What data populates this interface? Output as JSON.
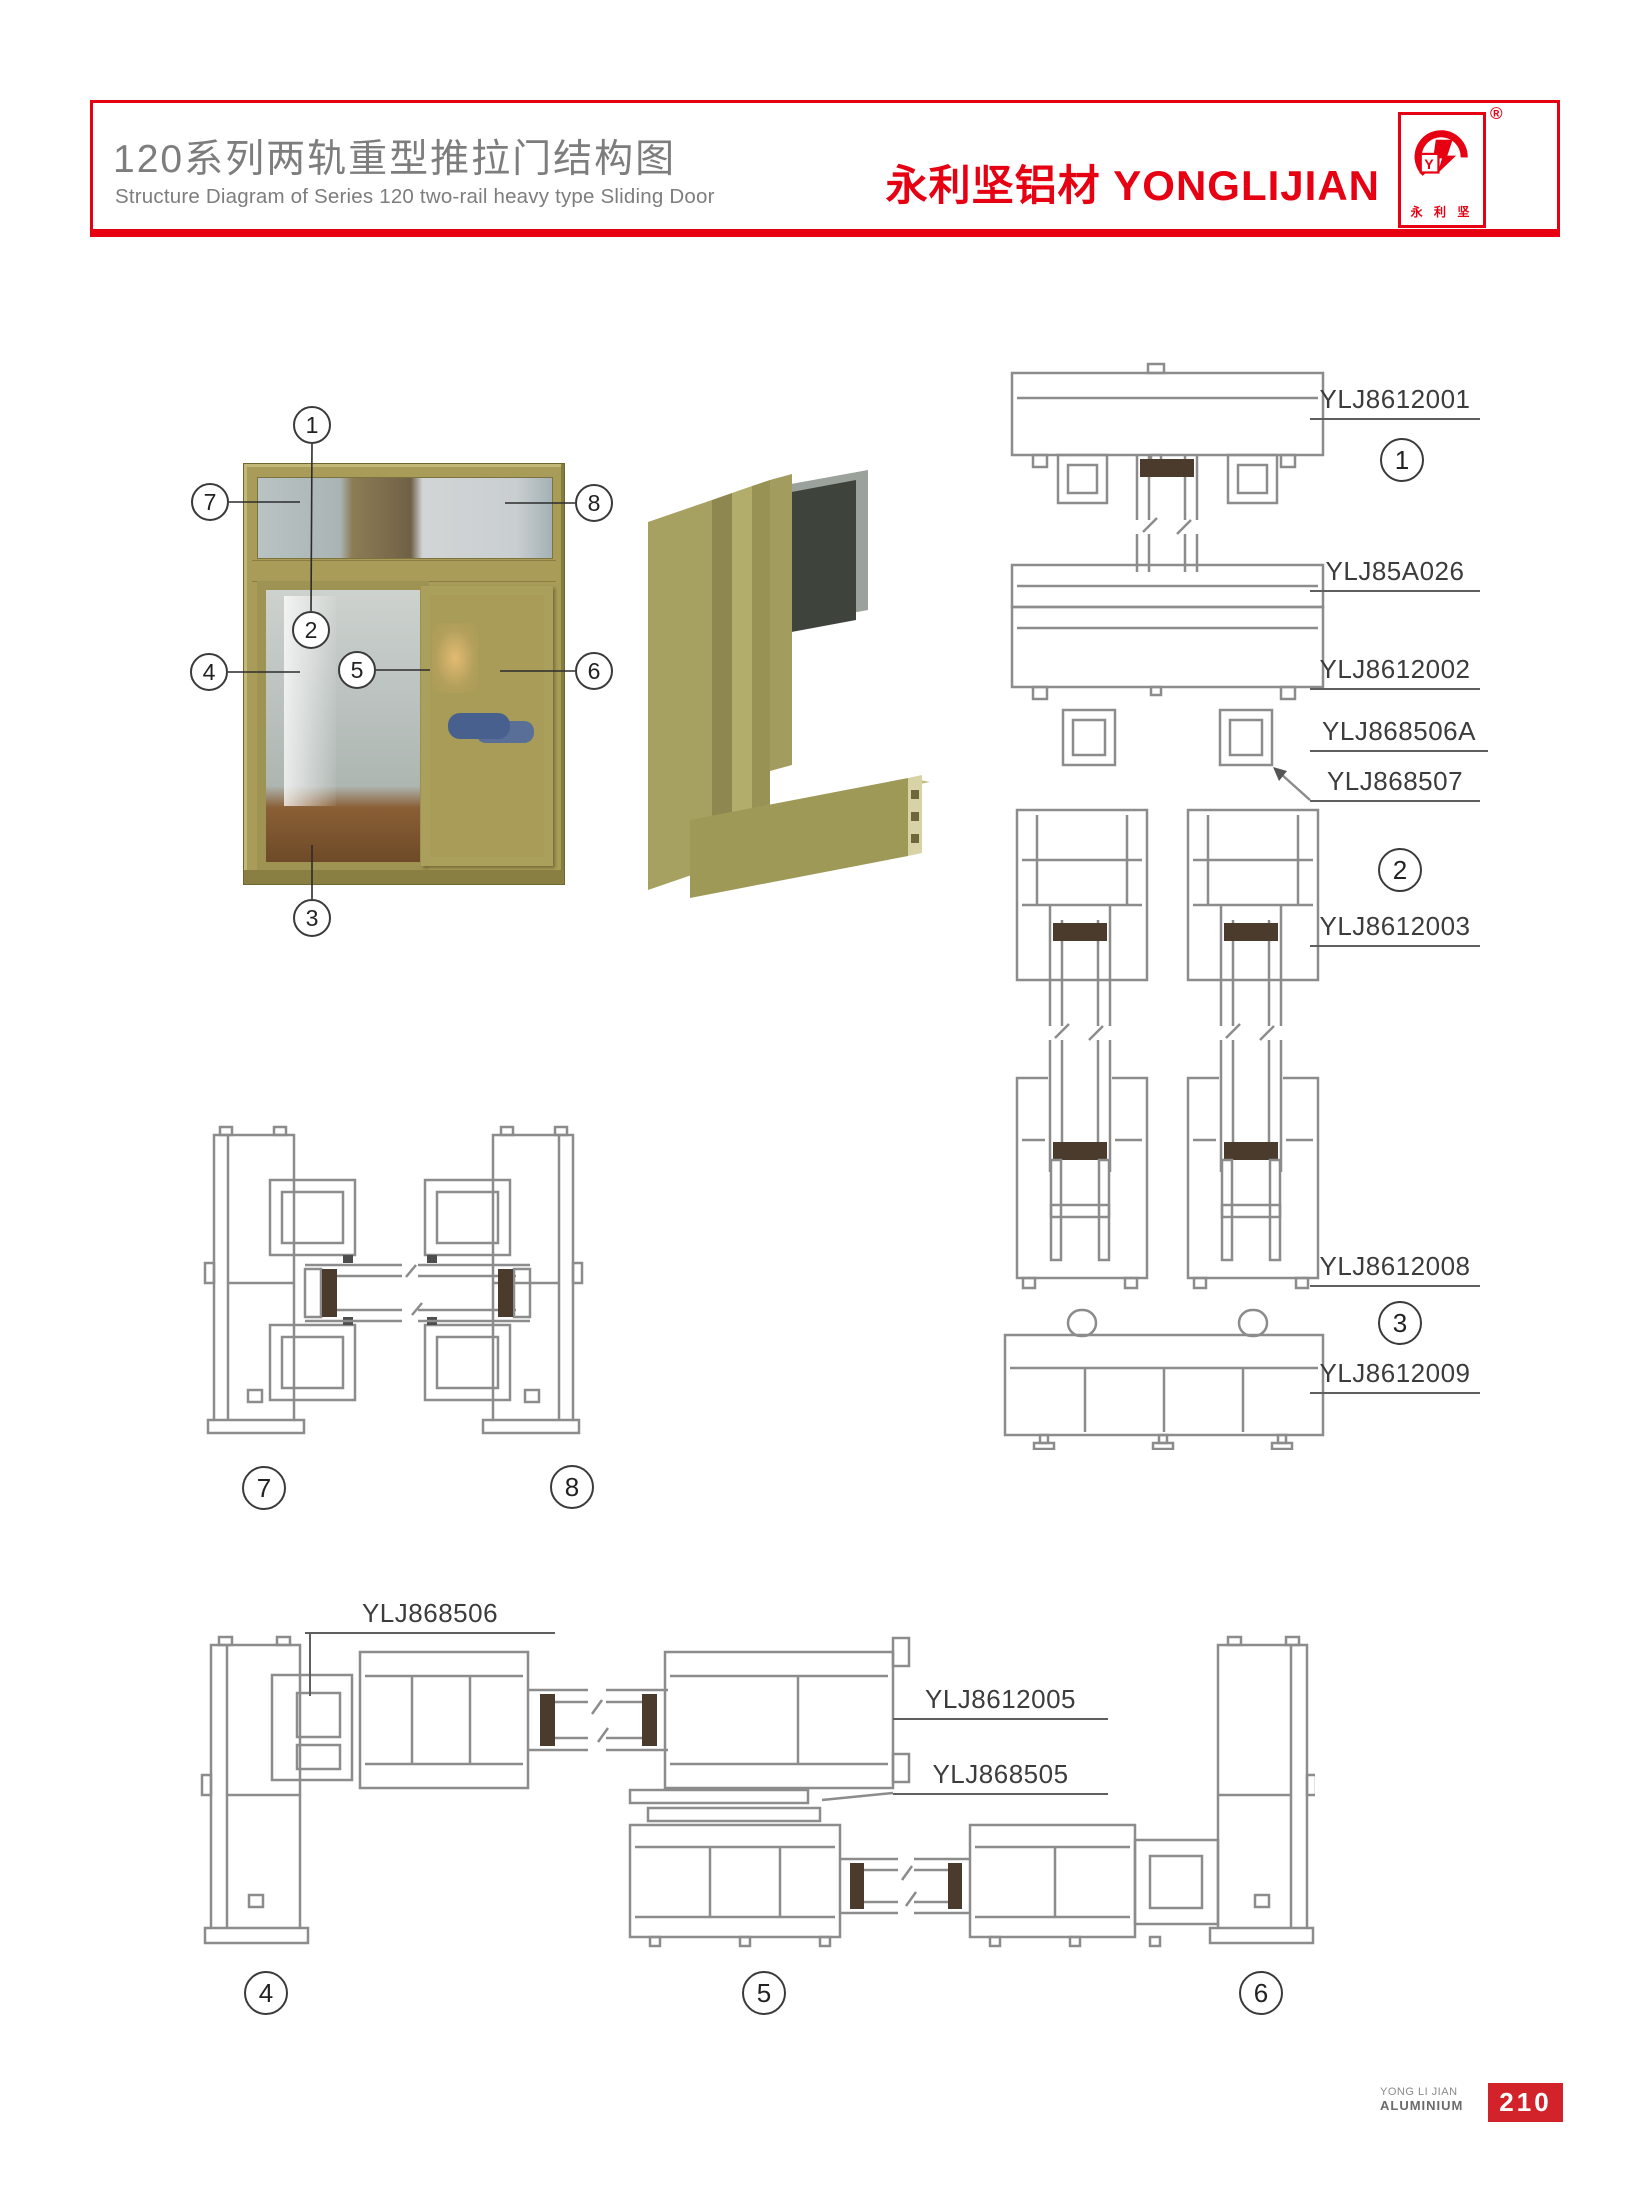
{
  "header": {
    "title_zh": "120系列两轨重型推拉门结构图",
    "title_en": "Structure Diagram of Series 120 two-rail heavy type Sliding Door",
    "brand": "永利坚铝材 YONGLIJIAN",
    "logo": {
      "registered": "®",
      "caption": "永 利 坚",
      "monogram": "Y"
    }
  },
  "colors": {
    "accent_red": "#e60012",
    "page_badge_red": "#d3232a",
    "title_gray": "#7d7d7d",
    "drawing_gray": "#8c8c8c",
    "frame_olive": "#a89c58"
  },
  "window_callouts": [
    "1",
    "7",
    "8",
    "2",
    "4",
    "5",
    "6",
    "3"
  ],
  "section_callouts": {
    "right": [
      "1",
      "2",
      "3"
    ],
    "middle": [
      "7",
      "8"
    ],
    "bottom": [
      "4",
      "5",
      "6"
    ]
  },
  "part_labels": {
    "right": [
      "YLJ8612001",
      "YLJ85A026",
      "YLJ8612002",
      "YLJ868506A",
      "YLJ868507",
      "YLJ8612003",
      "YLJ8612008",
      "YLJ8612009"
    ],
    "bottom": [
      "YLJ868506",
      "YLJ8612005",
      "YLJ868505"
    ]
  },
  "footer": {
    "company_line1": "YONG LI JIAN",
    "company_line2": "ALUMINIUM",
    "page_number": "210"
  }
}
